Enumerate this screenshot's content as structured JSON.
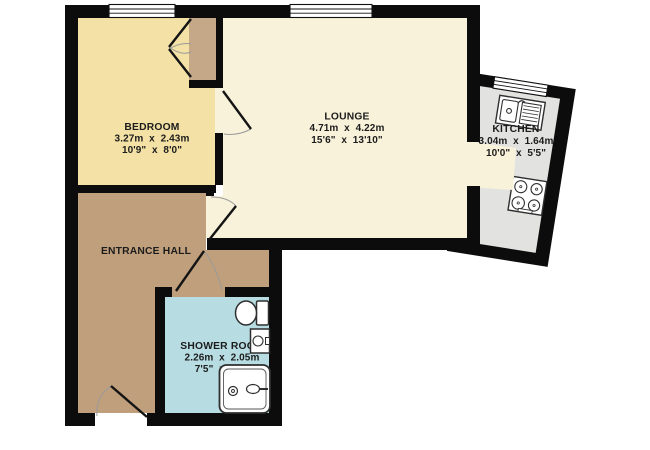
{
  "plan_title": "Flat floor plan",
  "canvas": {
    "width": 650,
    "height": 450,
    "background": "#ffffff",
    "wall_color": "#0c0c0c"
  },
  "style": {
    "door_leaf_color": "#141414",
    "door_arc_color": "#9a9a9a",
    "fixture_stroke": "#2f2f2f",
    "window_fill": "#ffffff",
    "closet_floor_color": "#c5a887"
  },
  "rooms": {
    "bedroom": {
      "name": "BEDROOM",
      "metric": "3.27m  x  2.43m",
      "imperial": "10'9\"  x  8'0\"",
      "floor_color": "#f3e1a5"
    },
    "lounge": {
      "name": "LOUNGE",
      "metric": "4.71m  x  4.22m",
      "imperial": "15'6\"  x  13'10\"",
      "floor_color": "#f8f2da"
    },
    "kitchen": {
      "name": "KITCHEN",
      "metric": "3.04m  x  1.64m",
      "imperial": "10'0\"  x  5'5\"",
      "floor_color": "#e2e2e0"
    },
    "entrance_hall": {
      "name": "ENTRANCE HALL",
      "floor_color": "#c09f7d"
    },
    "shower_room": {
      "name": "SHOWER ROOM",
      "metric": "2.26m  x  2.05m",
      "imperial": "7'5\"  x  6'9\"",
      "floor_color": "#b7dde3"
    }
  },
  "fixtures": {
    "kitchen_sink": "sink with drainer",
    "hob": "4-ring hob",
    "toilet": "toilet",
    "basin": "wash basin",
    "shower": "shower enclosure"
  }
}
